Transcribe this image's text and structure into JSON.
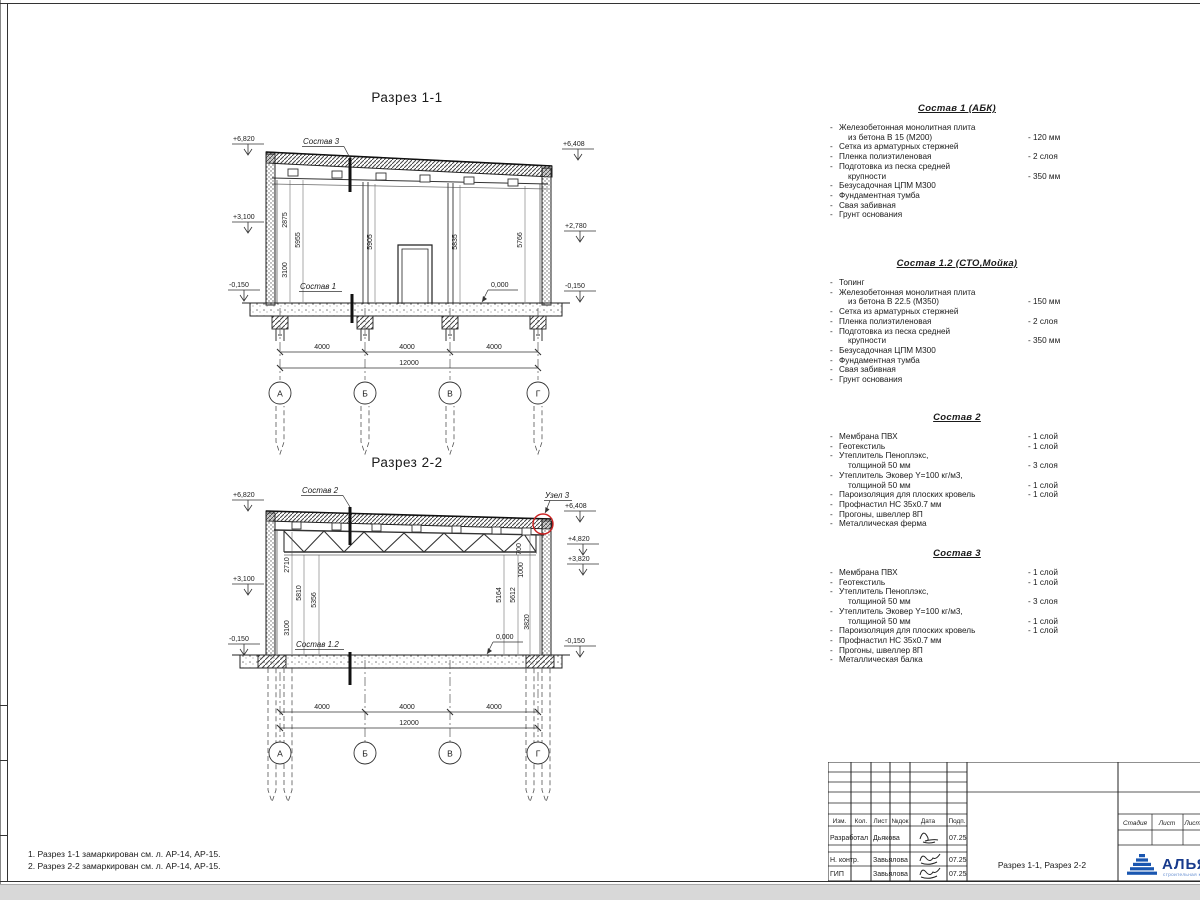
{
  "sections": {
    "s1": {
      "title": "Разрез 1-1",
      "sostav_top": "Состав 3",
      "sostav_bottom": "Состав 1",
      "zero": "0,000",
      "elev": {
        "tl": "+6,820",
        "ml": "+3,100",
        "bl": "-0,150",
        "tr": "+6,408",
        "mr": "+2,780",
        "br": "-0,150"
      },
      "vdims": [
        "2875",
        "5955",
        "3100",
        "5905",
        "5835",
        "5766"
      ],
      "hdims": [
        "4000",
        "4000",
        "4000"
      ],
      "total": "12000",
      "axes": [
        "А",
        "Б",
        "В",
        "Г"
      ]
    },
    "s2": {
      "title": "Разрез 2-2",
      "sostav_top": "Состав 2",
      "sostav_bottom": "Состав 1.2",
      "zero": "0,000",
      "node": "Узел 3",
      "elev": {
        "tl": "+6,820",
        "ml": "+3,100",
        "bl": "-0,150",
        "tr": "+6,408",
        "r2": "+4,820",
        "r3": "+3,820",
        "br": "-0,150"
      },
      "vleft": [
        "2710",
        "5810",
        "5356",
        "3100"
      ],
      "vright": [
        "700",
        "1000",
        "5164",
        "5612",
        "3820"
      ],
      "hdims": [
        "4000",
        "4000",
        "4000"
      ],
      "total": "12000",
      "axes": [
        "А",
        "Б",
        "В",
        "Г"
      ]
    }
  },
  "compositions": [
    {
      "title": "Состав 1 (АБК)",
      "rows": [
        {
          "bullet": true,
          "text": "Железобетонная  монолитная плита",
          "value": ""
        },
        {
          "bullet": false,
          "text": "из бетона В 15 (М200)",
          "value": "- 120 мм"
        },
        {
          "bullet": true,
          "text": "Сетка из арматурных стержней",
          "value": ""
        },
        {
          "bullet": true,
          "text": "Пленка полиэтиленовая",
          "value": "-  2 слоя"
        },
        {
          "bullet": true,
          "text": "Подготовка из песка средней",
          "value": ""
        },
        {
          "bullet": false,
          "text": "крупности",
          "value": "- 350 мм"
        },
        {
          "bullet": true,
          "text": "Безусадочная ЦПМ М300",
          "value": ""
        },
        {
          "bullet": true,
          "text": "Фундаментная тумба",
          "value": ""
        },
        {
          "bullet": true,
          "text": "Свая забивная",
          "value": ""
        },
        {
          "bullet": true,
          "text": "Грунт основания",
          "value": ""
        }
      ]
    },
    {
      "title": "Состав 1.2 (СТО,Мойка)",
      "rows": [
        {
          "bullet": true,
          "text": "Топинг",
          "value": ""
        },
        {
          "bullet": true,
          "text": "Железобетонная  монолитная плита",
          "value": ""
        },
        {
          "bullet": false,
          "text": "из бетона В 22.5 (М350)",
          "value": "- 150 мм"
        },
        {
          "bullet": true,
          "text": "Сетка из арматурных стержней",
          "value": ""
        },
        {
          "bullet": true,
          "text": "Пленка полиэтиленовая",
          "value": "-  2 слоя"
        },
        {
          "bullet": true,
          "text": "Подготовка из песка средней",
          "value": ""
        },
        {
          "bullet": false,
          "text": "крупности",
          "value": "- 350 мм"
        },
        {
          "bullet": true,
          "text": "Безусадочная ЦПМ М300",
          "value": ""
        },
        {
          "bullet": true,
          "text": "Фундаментная тумба",
          "value": ""
        },
        {
          "bullet": true,
          "text": "Свая забивная",
          "value": ""
        },
        {
          "bullet": true,
          "text": "Грунт основания",
          "value": ""
        }
      ]
    },
    {
      "title": "Состав 2",
      "rows": [
        {
          "bullet": true,
          "text": "Мембрана ПВХ",
          "value": "- 1 слой"
        },
        {
          "bullet": true,
          "text": "Геотекстиль",
          "value": "- 1 слой"
        },
        {
          "bullet": true,
          "text": "Утеплитель Пеноплэкс,",
          "value": ""
        },
        {
          "bullet": false,
          "text": "толщиной 50 мм",
          "value": "- 3 слоя"
        },
        {
          "bullet": true,
          "text": "Утеплитель Эковер Y=100 кг/м3,",
          "value": ""
        },
        {
          "bullet": false,
          "text": "толщиной 50 мм",
          "value": "- 1 слой"
        },
        {
          "bullet": true,
          "text": "Пароизоляция для плоских кровель",
          "value": "- 1 слой"
        },
        {
          "bullet": true,
          "text": "Профнастил НС 35х0.7 мм",
          "value": ""
        },
        {
          "bullet": true,
          "text": "Прогоны, швеллер 8П",
          "value": ""
        },
        {
          "bullet": true,
          "text": "Металлическая ферма",
          "value": ""
        }
      ]
    },
    {
      "title": "Состав 3",
      "rows": [
        {
          "bullet": true,
          "text": "Мембрана ПВХ",
          "value": "- 1 слой"
        },
        {
          "bullet": true,
          "text": "Геотекстиль",
          "value": "- 1 слой"
        },
        {
          "bullet": true,
          "text": "Утеплитель Пеноплэкс,",
          "value": ""
        },
        {
          "bullet": false,
          "text": "толщиной 50 мм",
          "value": "- 3 слоя"
        },
        {
          "bullet": true,
          "text": "Утеплитель Эковер Y=100 кг/м3,",
          "value": ""
        },
        {
          "bullet": false,
          "text": "толщиной 50 мм",
          "value": "- 1 слой"
        },
        {
          "bullet": true,
          "text": "Пароизоляция для плоских кровель",
          "value": "- 1 слой"
        },
        {
          "bullet": true,
          "text": "Профнастил НС 35х0.7 мм",
          "value": ""
        },
        {
          "bullet": true,
          "text": "Прогоны, швеллер 8П",
          "value": ""
        },
        {
          "bullet": true,
          "text": "Металлическая балка",
          "value": ""
        }
      ]
    }
  ],
  "notes": [
    "1. Разрез 1-1 замаркирован см. л. АР-14, АР-15.",
    "2. Разрез 2-2 замаркирован см. л. АР-14, АР-15."
  ],
  "titleblock": {
    "cols": [
      "Изм.",
      "Кол.",
      "Лист",
      "№док",
      "Подп.",
      "Дата"
    ],
    "rows": [
      {
        "role": "Разработал",
        "name": "Дьякова",
        "date": "07.25"
      },
      {
        "role": "Н. контр.",
        "name": "Завьялова",
        "date": "07.25"
      },
      {
        "role": "ГИП",
        "name": "Завьялова",
        "date": "07.25"
      }
    ],
    "doc_title": "Разрез 1-1, Разрез 2-2",
    "stage_cols": [
      "Стадия",
      "Лист",
      "Листов"
    ],
    "logo": {
      "name": "АЛЬЯНС",
      "sub": "строительная компания"
    },
    "colors": {
      "logo_blue": "#1a56b0",
      "logo_text": "#173a8c",
      "node_red": "#cc2222"
    }
  }
}
